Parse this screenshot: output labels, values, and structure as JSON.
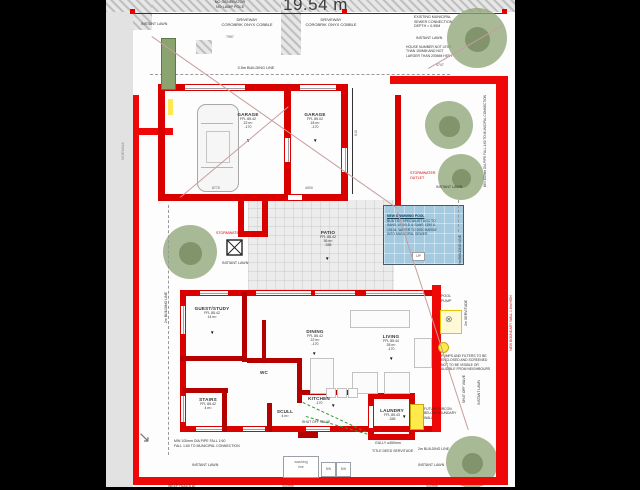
{
  "title": {
    "plot_width": "19.54 m"
  },
  "rooms": {
    "garage_left": {
      "name": "GARAGE",
      "ffl": "FFL 85.42",
      "area": "22 m²",
      "level": "-170"
    },
    "garage_right": {
      "name": "GARAGE",
      "ffl": "FFL 85.02",
      "area": "18 m²",
      "level": "-170"
    },
    "patio": {
      "name": "PATIO",
      "ffl": "FFL 85.42",
      "area": "36 m²",
      "level": "-345"
    },
    "guest_study": {
      "name": "GUEST/STUDY",
      "ffl": "FFL 85.42",
      "area": "14 m²",
      "level": "-170"
    },
    "wc": {
      "name": "WC"
    },
    "stairs": {
      "name": "STAIRS",
      "ffl": "FFL 85.42",
      "area": "4 m²",
      "level": "-170"
    },
    "dining": {
      "name": "DINING",
      "ffl": "FFL 85.42",
      "area": "22 m²",
      "level": "-170"
    },
    "living": {
      "name": "LIVING",
      "ffl": "FFL 85.44",
      "area": "28 m²",
      "level": "-170"
    },
    "kitchen": {
      "name": "KITCHEN",
      "level": "-170"
    },
    "scullery": {
      "name": "SCULL",
      "area": "4 m²"
    },
    "laundry": {
      "name": "LAUNDRY",
      "ffl": "FFL 85.43",
      "level": "-345"
    }
  },
  "dims": {
    "garage_left_width": "8770",
    "garage_right_width": "4000",
    "driveway": "7997",
    "top_right": "4747",
    "side_court": "610",
    "weep_spacing": "400mm"
  },
  "notes": {
    "pole_note": "NO GENERATOR\nNO LAMP POLE",
    "driveway": "DRIVEWAY\nCOROBRIK ONYX COBBLE",
    "building_line_35": "3.5m BUILDING LINE",
    "building_line_2m": "2m BUILDING LINE",
    "servitude_2m": "2m SERVITUDE",
    "instant_lawn": "INSTANT LAWN",
    "sewer": "EXISTING MUNICIPAL\nSEWER CONNECTION\nDEPTH = 0.95M",
    "house_number": "HOUSE NUMBER NOT LESS\nTHAN 150MM AND NOT\nLARGER THAN 200MM HIGH",
    "stormwater_outlet": "STORMWATER\nOUTLET",
    "stormwater": "STORMWATER",
    "pool_title": "NEW SWIMMING POOL",
    "pool_body": "BUILT BY SPECIALIST ACC TO\nSANS 10400-D & SANS 1390 &\n10134. WATER TO DISCHARGE\nINTO MUNICIPAL SEWER",
    "pool_pump": "POOL\nPUMP",
    "pumps": "PUMPS AND FILTERS TO BE\nENCLOSED AND SCREENED\nNOT TO BE VISIBLE OR\nAUDIBLE FROM NEIGHBOURS",
    "future_aircon": "FUTURE AIRCON\nBELOW BOUNDARY\nWALL",
    "shut_off_valve": "SHUT OFF VALVE",
    "gully": "GULLY  ⌀450mm",
    "title_deed": "TITLE DEED SERVITUDE",
    "pipe_fall": "MIN 100mm DIA PIPE FALL 1:60\nFALL 1:60 TO MUNICIPAL CONNECTION",
    "pipe_fall_vertical": "MIN 100mm DIA PIPE FALL 1:60 TO MUNICIPAL CONNECTION",
    "washing_line": "washing\nline",
    "bin": "BIN",
    "weep_holes": "WEEP HOLES AT",
    "boundary_wall": "NEW BOUNDARY WALL 1.8m HIGH",
    "sidewalk": "SIDEWALK",
    "up": "UP"
  },
  "colors": {
    "wall_red": "#d90000",
    "boundary_red": "#ee0808",
    "pool_blue": "#a5c9de",
    "tree_green": "#8fa578",
    "highlight_yellow": "#ffe94d",
    "note_red": "#d40000"
  }
}
